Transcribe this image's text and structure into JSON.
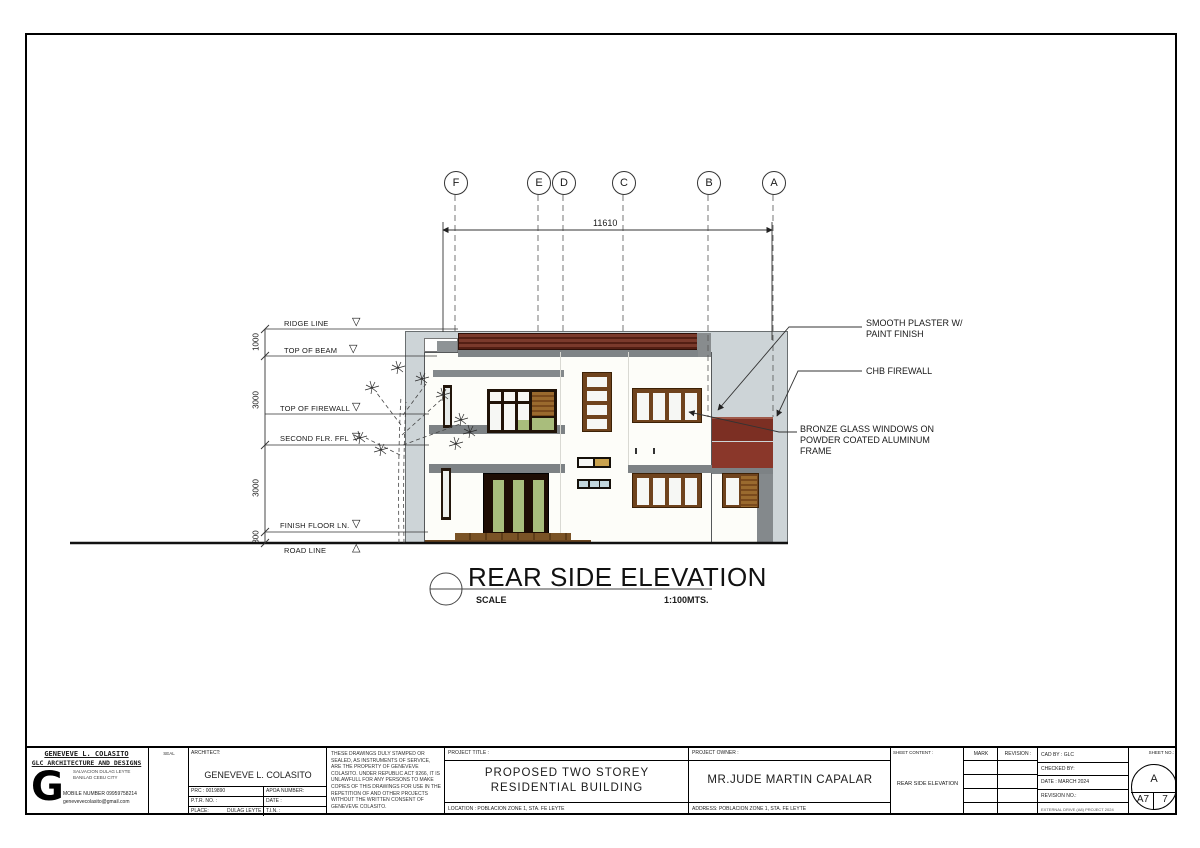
{
  "drawing": {
    "grid_bubbles": [
      "F",
      "E",
      "D",
      "C",
      "B",
      "A"
    ],
    "top_dimension": "11610",
    "levels": [
      "RIDGE LINE",
      "TOP OF BEAM",
      "TOP OF FIREWALL",
      "SECOND FLR. FFL",
      "FINISH FLOOR LN.",
      "ROAD LINE"
    ],
    "vertical_dims": [
      "1000",
      "3000",
      "3000",
      "300"
    ],
    "annotations": {
      "plaster": "SMOOTH PLASTER W/ PAINT FINISH",
      "chb": "CHB FIREWALL",
      "bronze": "BRONZE GLASS WINDOWS ON POWDER COATED ALUMINUM FRAME"
    },
    "title": "REAR SIDE ELEVATION",
    "scale_label": "SCALE",
    "scale_value": "1:100MTS."
  },
  "title_block": {
    "firm": {
      "name": "GENEVEVE L. COLASITO",
      "tagline": "GLC ARCHITECTURE AND DESIGNS",
      "address1": "SALVACION DULAG LEYTE",
      "address2": "BANILAD CEBU CITY",
      "mobile": "MOBILE NUMBER 09959758214",
      "email": "genevevecolasito@gmail.com",
      "logo": "G"
    },
    "seal_label": "SEAL",
    "architect": {
      "header": "ARCHITECT:",
      "name": "GENEVEVE L. COLASITO",
      "prc": "PRC : 0019890",
      "apoa": "APOA NUMBER:",
      "ptr": "P.T.R. NO. :",
      "date": "DATE :",
      "place": "PLACE:",
      "place_value": "DULAG LEYTE",
      "tin": "T.I.N. :"
    },
    "disclaimer": "THESE DRAWINGS DULY STAMPED OR SEALED, AS INSTRUMENTS OF SERVICE, ARE THE PROPERTY OF GENEVEVE COLASITO. UNDER REPUBLIC ACT 9266, IT IS UNLAWFULL FOR ANY PERSONS TO MAKE COPIES OF THIS DRAWINGS FOR USE IN THE REPETITION OF AND OTHER PROJECTS WITHOUT THE WRITTEN CONSENT OF GENEVEVE COLASITO.",
    "project": {
      "header": "PROJECT TITLE :",
      "line1": "PROPOSED TWO STOREY",
      "line2": "RESIDENTIAL BUILDING",
      "location": "LOCATION :  POBLACION ZONE 1, STA. FE LEYTE"
    },
    "owner": {
      "header": "PROJECT OWNER :",
      "name": "MR.JUDE MARTIN CAPALAR",
      "address": "ADDRESS: POBLACION ZONE 1, STA. FE LEYTE"
    },
    "sheet_content": {
      "header": "SHEET CONTENT :",
      "value": "REAR SIDE ELEVATION"
    },
    "mark_header": "MARK",
    "revision_header": "REVISION :",
    "cad": {
      "cad_by": "CAD BY :   GLC",
      "checked_by": "CHECKED BY:",
      "date": "DATE : MARCH 2024",
      "revision_no": "REVISION NO.:",
      "note": "EXTERNAL DRIVE (A8) PROJECT 2024"
    },
    "sheet_no": {
      "header": "SHEET NO.:",
      "top": "A",
      "bottom_left": "A7",
      "bottom_right": "7"
    }
  },
  "colors": {
    "roof_maroon": "#6e2b20",
    "firewall_maroon": "#7c2f23",
    "slab_gray": "#7d8285",
    "back_wall": "#cdd4d7",
    "frame_dark": "#201308",
    "frame_brown": "#6f431d",
    "glass_green": "#a9bd7c",
    "glass_blue": "#c3d6dc",
    "wood": "#8a5a26"
  }
}
